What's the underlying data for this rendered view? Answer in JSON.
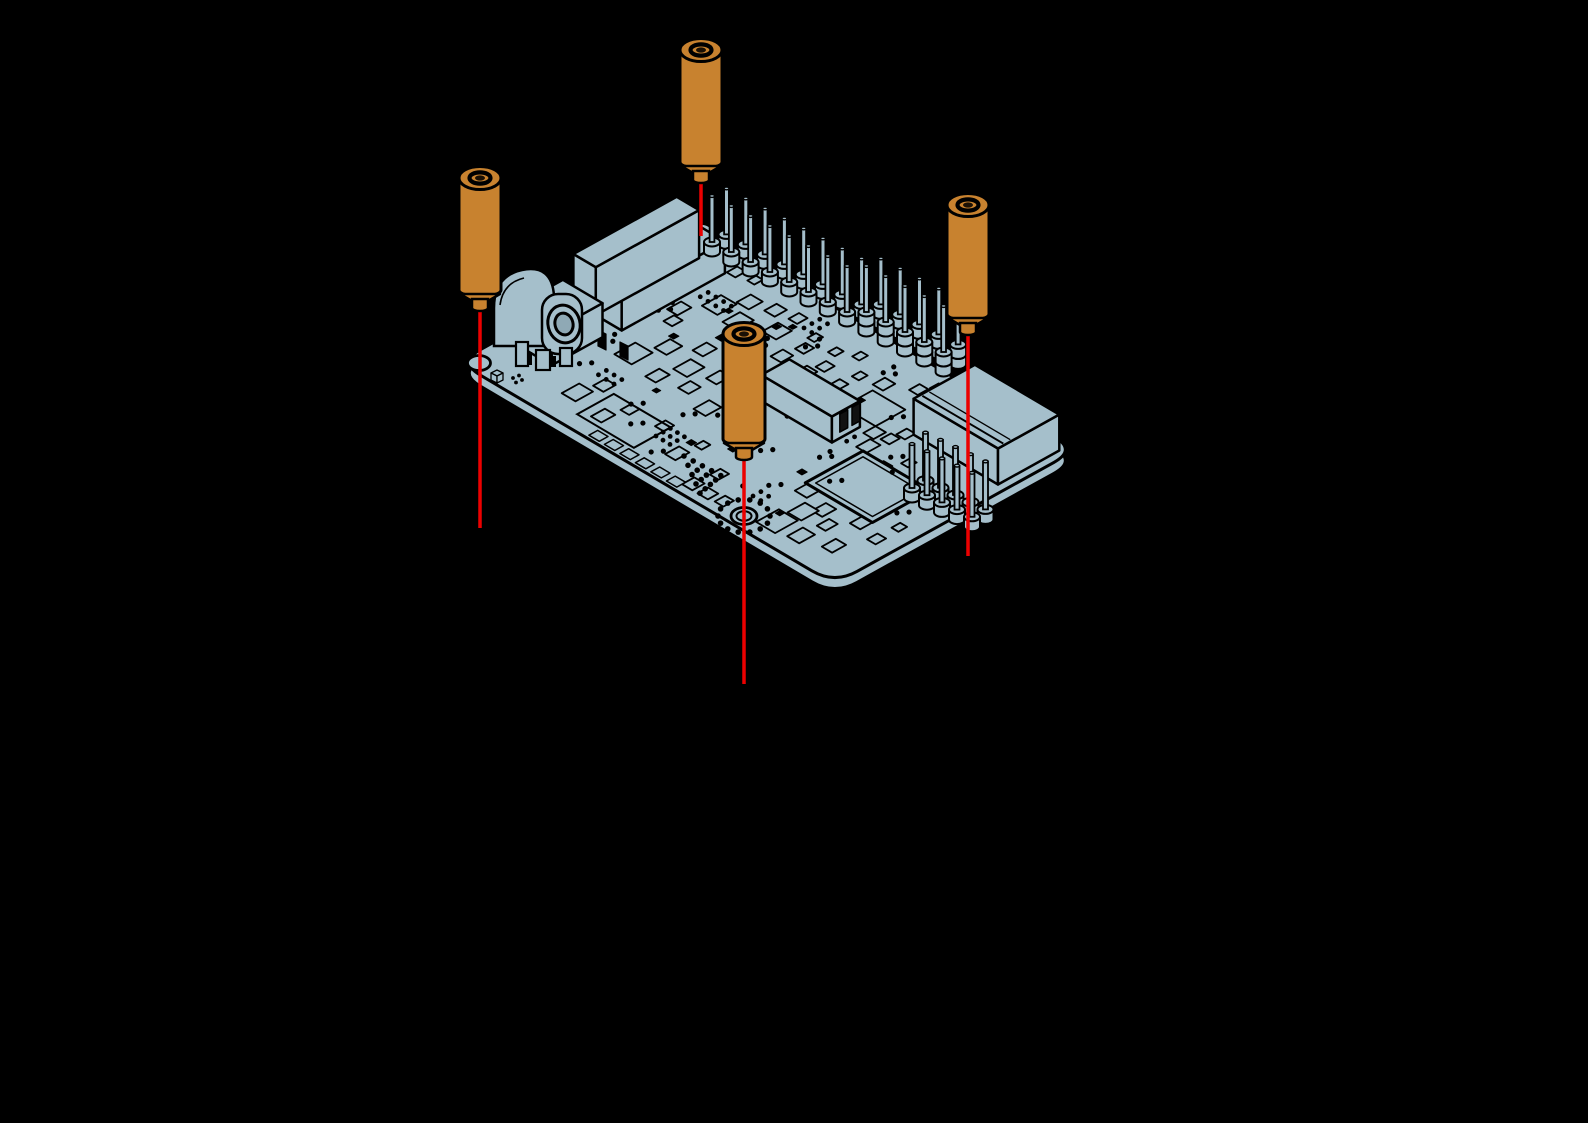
{
  "figure": {
    "title": "Attaching brass standoffs to the circuit board mounting holes",
    "description": "Isometric exploded view of a single-board computer with four brass hex standoffs aligned above the four mounting holes; red guide lines indicate the insertion direction through each hole.",
    "board_name": "single-board computer PCB",
    "standoff_count": "4",
    "mounting_hole_count": "4",
    "guide_line_count": "4"
  },
  "parts": {
    "standoff": "brass-hex-standoff",
    "hole": "mounting-hole",
    "guide": "alignment-guide-line",
    "ethernet": "ethernet-port",
    "barrel_jack": "dc-barrel-jack",
    "gpio": "gpio-pin-header",
    "usb": "usb-host-port",
    "serial": "serial-pin-header",
    "processor": "processor-chip",
    "sd": "sd-card-slot-outline"
  },
  "colors": {
    "background": "#000000",
    "board_fill": "#a5bfcb",
    "board_shade": "#8fa9b5",
    "outline": "#000000",
    "standoff_fill": "#c8822f",
    "standoff_dark": "#1a1005",
    "guide_line": "#ec0000"
  }
}
